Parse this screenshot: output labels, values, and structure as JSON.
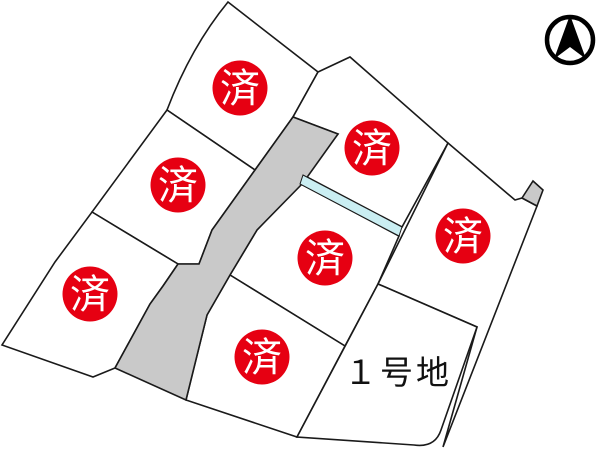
{
  "map": {
    "title_hint": "subdivision-lot-map",
    "colors": {
      "sold_red": "#e60012",
      "available_yellow": "#fbf9d0",
      "road_gray": "#c9c9c9",
      "water_cyan": "#caeef2",
      "line": "#1a1a1a",
      "background": "#ffffff"
    },
    "sold_lots": [
      {
        "label": "済",
        "x": 240,
        "y": 88
      },
      {
        "label": "済",
        "x": 178,
        "y": 185
      },
      {
        "label": "済",
        "x": 90,
        "y": 294
      },
      {
        "label": "済",
        "x": 372,
        "y": 148
      },
      {
        "label": "済",
        "x": 325,
        "y": 258
      },
      {
        "label": "済",
        "x": 262,
        "y": 357
      },
      {
        "label": "済",
        "x": 463,
        "y": 236
      }
    ],
    "available_lot": {
      "label": "１号地",
      "label_x": 398,
      "label_y": 384
    }
  },
  "compass": {
    "icon": "north-arrow-compass-icon"
  }
}
